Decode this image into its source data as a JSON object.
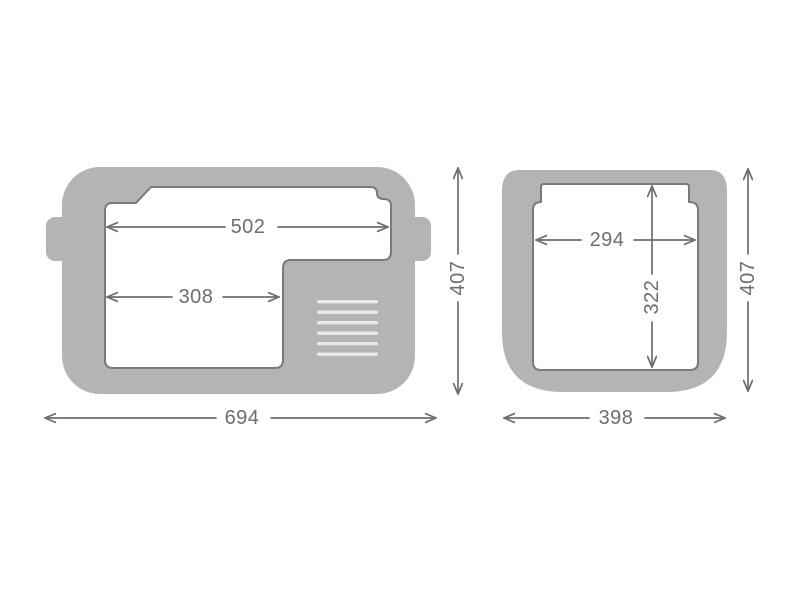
{
  "diagram": {
    "type": "technical-drawing",
    "units_implied": "mm",
    "side_view": {
      "inner_top_width": "502",
      "inner_base_width": "308",
      "overall_width": "694",
      "overall_height": "407",
      "vent_slat_count": 6
    },
    "front_view": {
      "inner_width": "294",
      "inner_depth": "322",
      "overall_width": "398",
      "overall_height": "407"
    },
    "colors": {
      "body_gray": "#b4b4b4",
      "cavity_outline": "#7a7a7a",
      "dimension_gray": "#6e6e6e",
      "vent_slat": "#e9e9e9",
      "background": "#ffffff"
    }
  }
}
